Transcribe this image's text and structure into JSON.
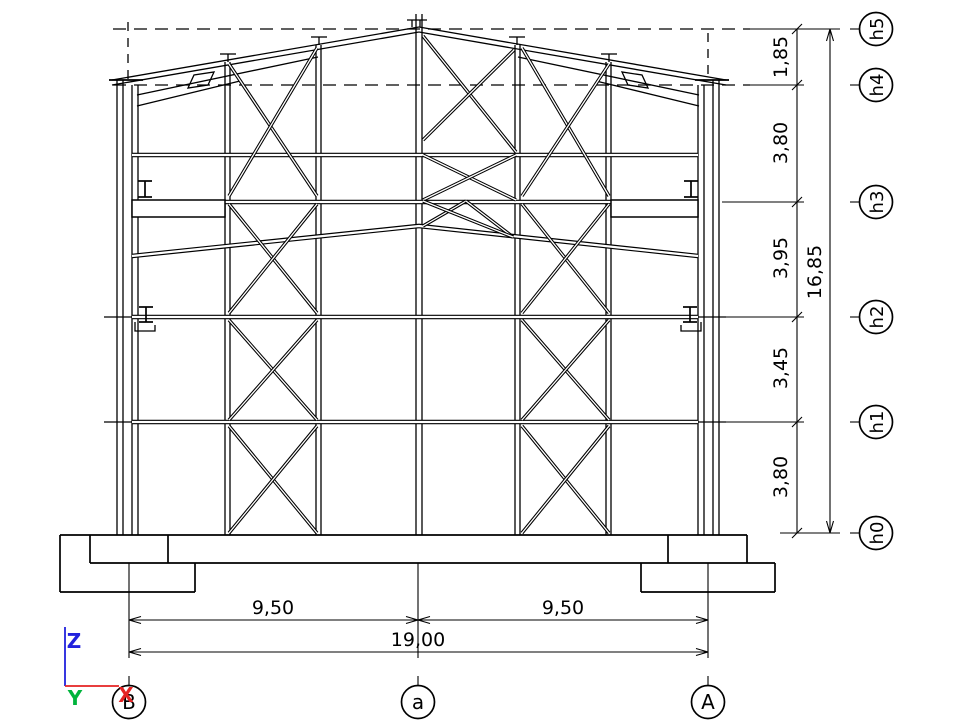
{
  "levels": {
    "labels": [
      "h5",
      "h4",
      "h3",
      "h2",
      "h1",
      "h0"
    ]
  },
  "vertical_dims": {
    "segments": [
      "1,85",
      "3,80",
      "3,95",
      "3,45",
      "3,80"
    ],
    "total": "16,85"
  },
  "horizontal_dims": {
    "segments": [
      "9,50",
      "9,50"
    ],
    "total": "19,00"
  },
  "grid_axes": {
    "labels": [
      "B",
      "a",
      "A"
    ]
  },
  "coord_triad": {
    "z_label": "Z",
    "y_label": "Y",
    "x_label": "X",
    "z_color": "#2222dd",
    "y_color": "#00b43c",
    "x_color": "#e42222"
  },
  "drawing_color": "#000000",
  "background_color": "#ffffff"
}
